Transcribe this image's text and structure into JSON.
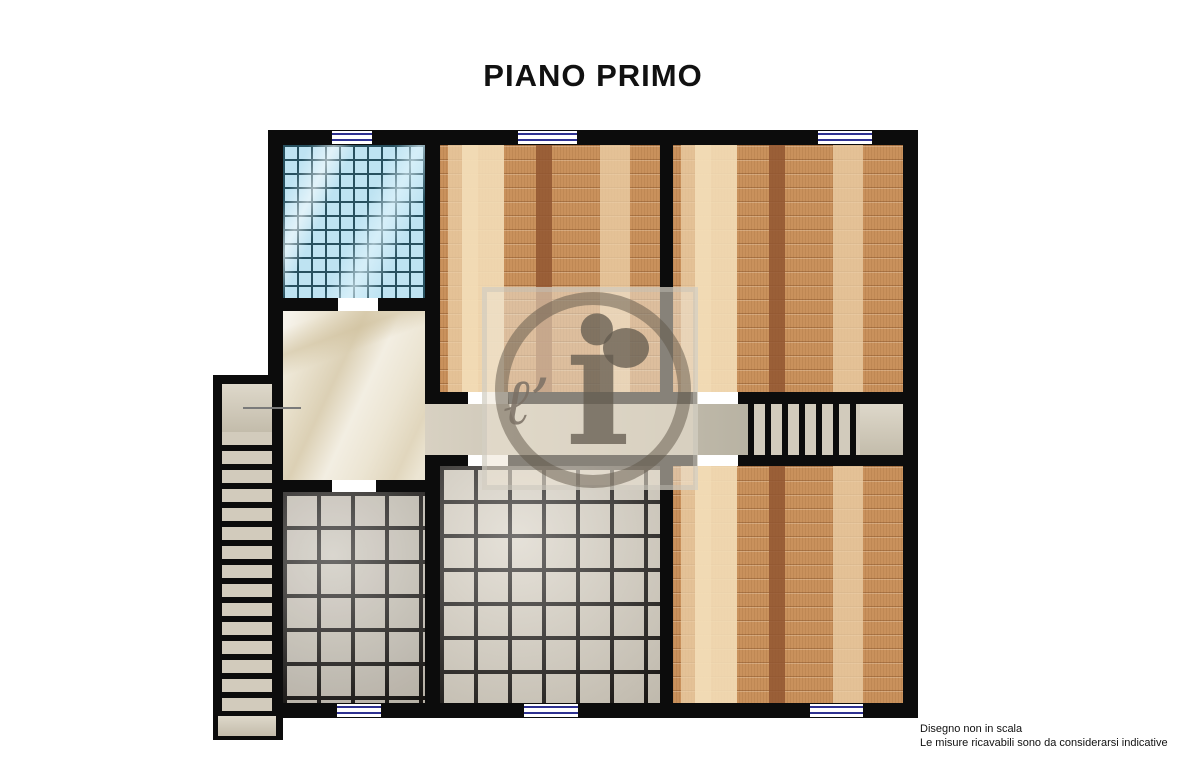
{
  "title": "PIANO PRIMO",
  "footer": {
    "line1": "Disegno non in scala",
    "line2": "Le misure ricavabili sono da considerarsi indicative"
  },
  "watermark": {
    "script": "ℓ’",
    "letter": "i"
  },
  "colors": {
    "wall": "#0c0c0c",
    "window_line": "#2e3191",
    "wood_base": "#c9915c",
    "bath_tile": "#bee3f2",
    "bath_grid": "#27505f",
    "tile_floor": "#d5cec0",
    "hallway_floor": "#ece5d3",
    "corridor_a": "#d8d1c2",
    "corridor_b": "#a9a494",
    "stair_tread": "#d2cbbc",
    "text": "#111111"
  }
}
